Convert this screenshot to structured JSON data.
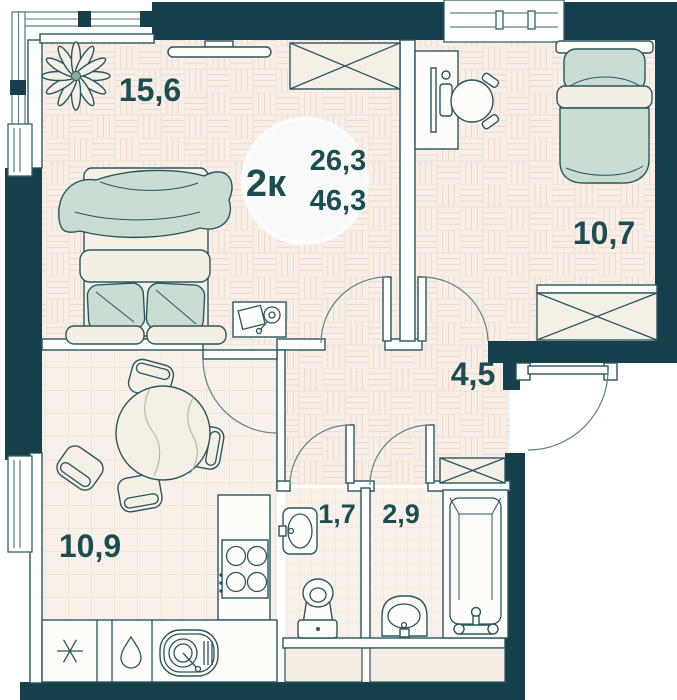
{
  "plan": {
    "badge": {
      "type_label": "2к",
      "living_area": "26,3",
      "total_area": "46,3"
    },
    "rooms": [
      {
        "id": "living-room",
        "area": "15,6"
      },
      {
        "id": "bedroom",
        "area": "10,7"
      },
      {
        "id": "hallway",
        "area": "4,5"
      },
      {
        "id": "kitchen",
        "area": "10,9"
      },
      {
        "id": "bathroom",
        "area": "1,7"
      },
      {
        "id": "toilet",
        "area": "2,9"
      }
    ],
    "colors": {
      "wall": "#153f4b",
      "line": "#29565e",
      "label": "#1c4d52",
      "furniture_green": "#c9ddd3",
      "floor_base": "#f8f0e8"
    }
  }
}
